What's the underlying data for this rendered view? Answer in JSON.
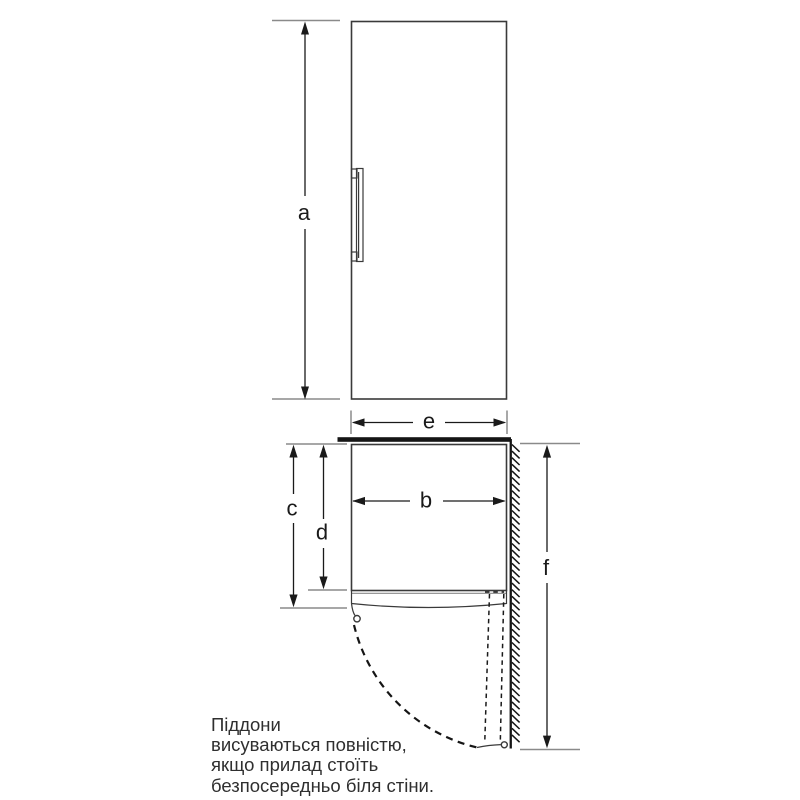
{
  "colors": {
    "outline": "#3a3a3a",
    "dimension": "#1a1a1a",
    "extension": "#8a8a8a",
    "wall": "#151515",
    "background": "#ffffff",
    "label": "#1a1a1a",
    "note_text": "#2f2f2f"
  },
  "dimensions": {
    "a": "a",
    "b": "b",
    "c": "c",
    "d": "d",
    "e": "e",
    "f": "f"
  },
  "note": {
    "lines": [
      "Піддони",
      "висуваються повністю,",
      "якщо прилад стоїть",
      "безпосередньо біля стіни."
    ]
  }
}
